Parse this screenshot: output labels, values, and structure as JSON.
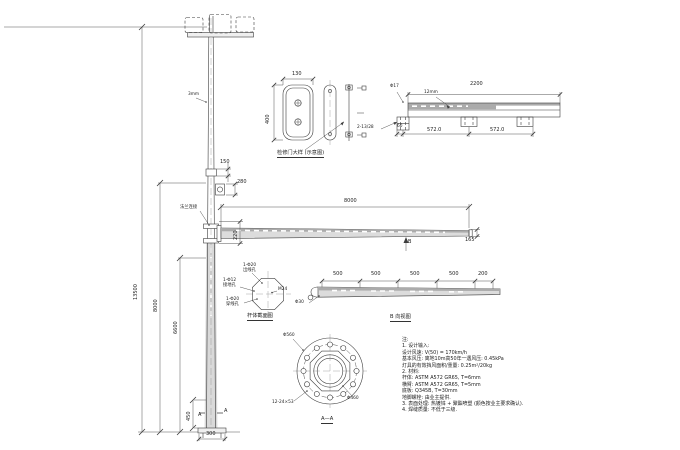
{
  "palette": {
    "line": "#3d3d3d",
    "fill_light": "#dcdcdc",
    "fill_dark": "#ababab",
    "background": "#ffffff"
  },
  "main_view": {
    "dim_total_height": "13500",
    "dim_height_8000": "8000",
    "dim_height_6600": "6600",
    "top_note": "3mm",
    "dim_slip_joint": "150",
    "dim_device": "280",
    "joint_label": "法兰连接",
    "dim_arm_length": "8000",
    "dim_arm_root": "220",
    "dim_arm_tip": "165",
    "view_marker_b": "B",
    "dim_handhole": "450",
    "section_mark": "A",
    "dim_base": "300"
  },
  "door_detail": {
    "dim_width": "130",
    "dim_height": "400",
    "caption": "检修门大样 (示意图)"
  },
  "beam_top_view": {
    "dim_length": "2200",
    "plate_note": "12mm",
    "hole_note": "Φ17",
    "slot_note": "2-13/28",
    "dim_60": "60",
    "dim_span1": "572.0",
    "dim_span2": "572.0"
  },
  "beam_side_view": {
    "dim_1": "500",
    "dim_2": "500",
    "dim_3": "500",
    "dim_4": "500",
    "dim_5": "200",
    "hole_note": "Φ30",
    "caption": "B 向视图"
  },
  "pole_section": {
    "hole_top_1": "1-Φ20",
    "hole_top_2": "出线孔",
    "hole_left_1": "1-Φ12",
    "hole_left_2": "接地孔",
    "hole_bottom_1": "1-Φ20",
    "hole_bottom_2": "穿线孔",
    "bolt_note": "M24",
    "caption": "杆体截面图"
  },
  "flange_section": {
    "outer_dia": "Φ560",
    "slot_note": "12-24×53",
    "bolt_circle_dia": "Φ460",
    "caption": "A—A"
  },
  "notes": {
    "lines": [
      "注:",
      "1. 设计输入:",
      "   设计风速: V(50) = 170km/h",
      "   基本风压: 离地10m高50年一遇风压: 0.45kPa",
      "   灯具的有效挡风面积/重量: 0.25m²/20kg",
      "2. 材料:",
      "   杆体: ASTM A572 GR65, T=6mm",
      "   横臂: ASTM A572 GR65, T=5mm",
      "   底板: Q345B, T=30mm",
      "   地脚螺栓: 由业主提供.",
      "3. 表面处理: 热镀锌 + 聚酯喷塑 (颜色按业主要求确认).",
      "4. 焊缝质量: 不低于三级."
    ]
  }
}
